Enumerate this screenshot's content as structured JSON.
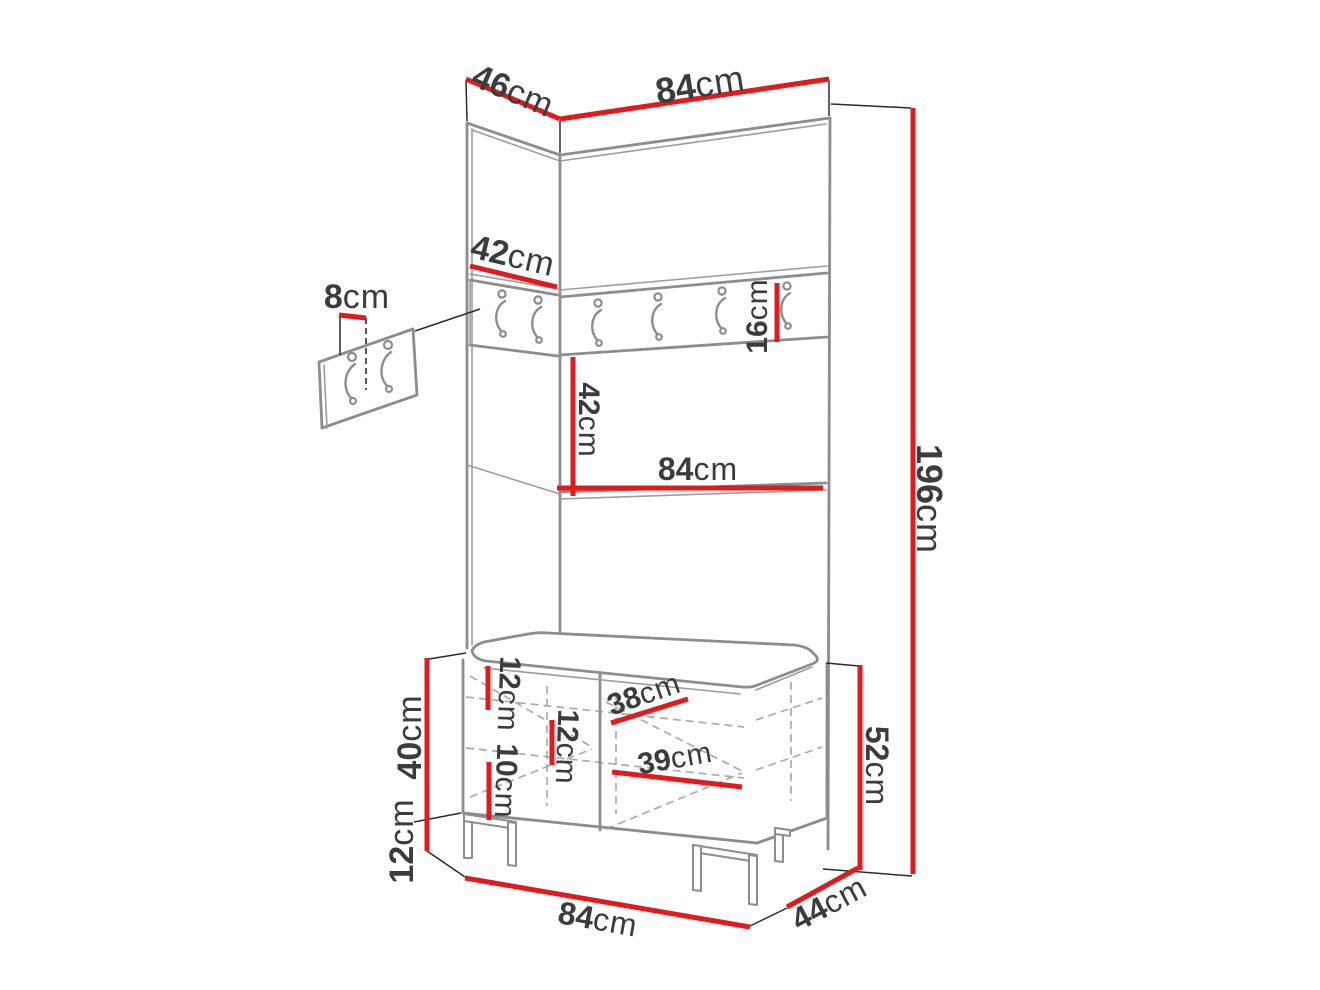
{
  "diagram_unit": "cm",
  "colors": {
    "dimension_red": "#e4191c",
    "outline_gray": "#8d8d8d",
    "text_dark": "#3c3c3c"
  },
  "icons": {
    "coat_hook": "coat-hook-icon"
  },
  "dims": {
    "top_depth": {
      "num": "46",
      "unit": "cm"
    },
    "top_width": {
      "num": "84",
      "unit": "cm"
    },
    "total_height": {
      "num": "196",
      "unit": "cm"
    },
    "side_rail_width": {
      "num": "42",
      "unit": "cm"
    },
    "hook_offset": {
      "num": "8",
      "unit": "cm"
    },
    "rail_height": {
      "num": "16",
      "unit": "cm"
    },
    "under_rail_height": {
      "num": "42",
      "unit": "cm"
    },
    "mid_width": {
      "num": "84",
      "unit": "cm"
    },
    "cabinet_height": {
      "num": "40",
      "unit": "cm"
    },
    "leg_height": {
      "num": "12",
      "unit": "cm"
    },
    "inner_gap_top": {
      "num": "12",
      "unit": "cm"
    },
    "inner_gap_mid": {
      "num": "12",
      "unit": "cm"
    },
    "inner_gap_low": {
      "num": "10",
      "unit": "cm"
    },
    "inner_depth_upper": {
      "num": "38",
      "unit": "cm"
    },
    "inner_depth_lower": {
      "num": "39",
      "unit": "cm"
    },
    "bench_height": {
      "num": "52",
      "unit": "cm"
    },
    "bench_width": {
      "num": "84",
      "unit": "cm"
    },
    "bench_depth": {
      "num": "44",
      "unit": "cm"
    }
  }
}
